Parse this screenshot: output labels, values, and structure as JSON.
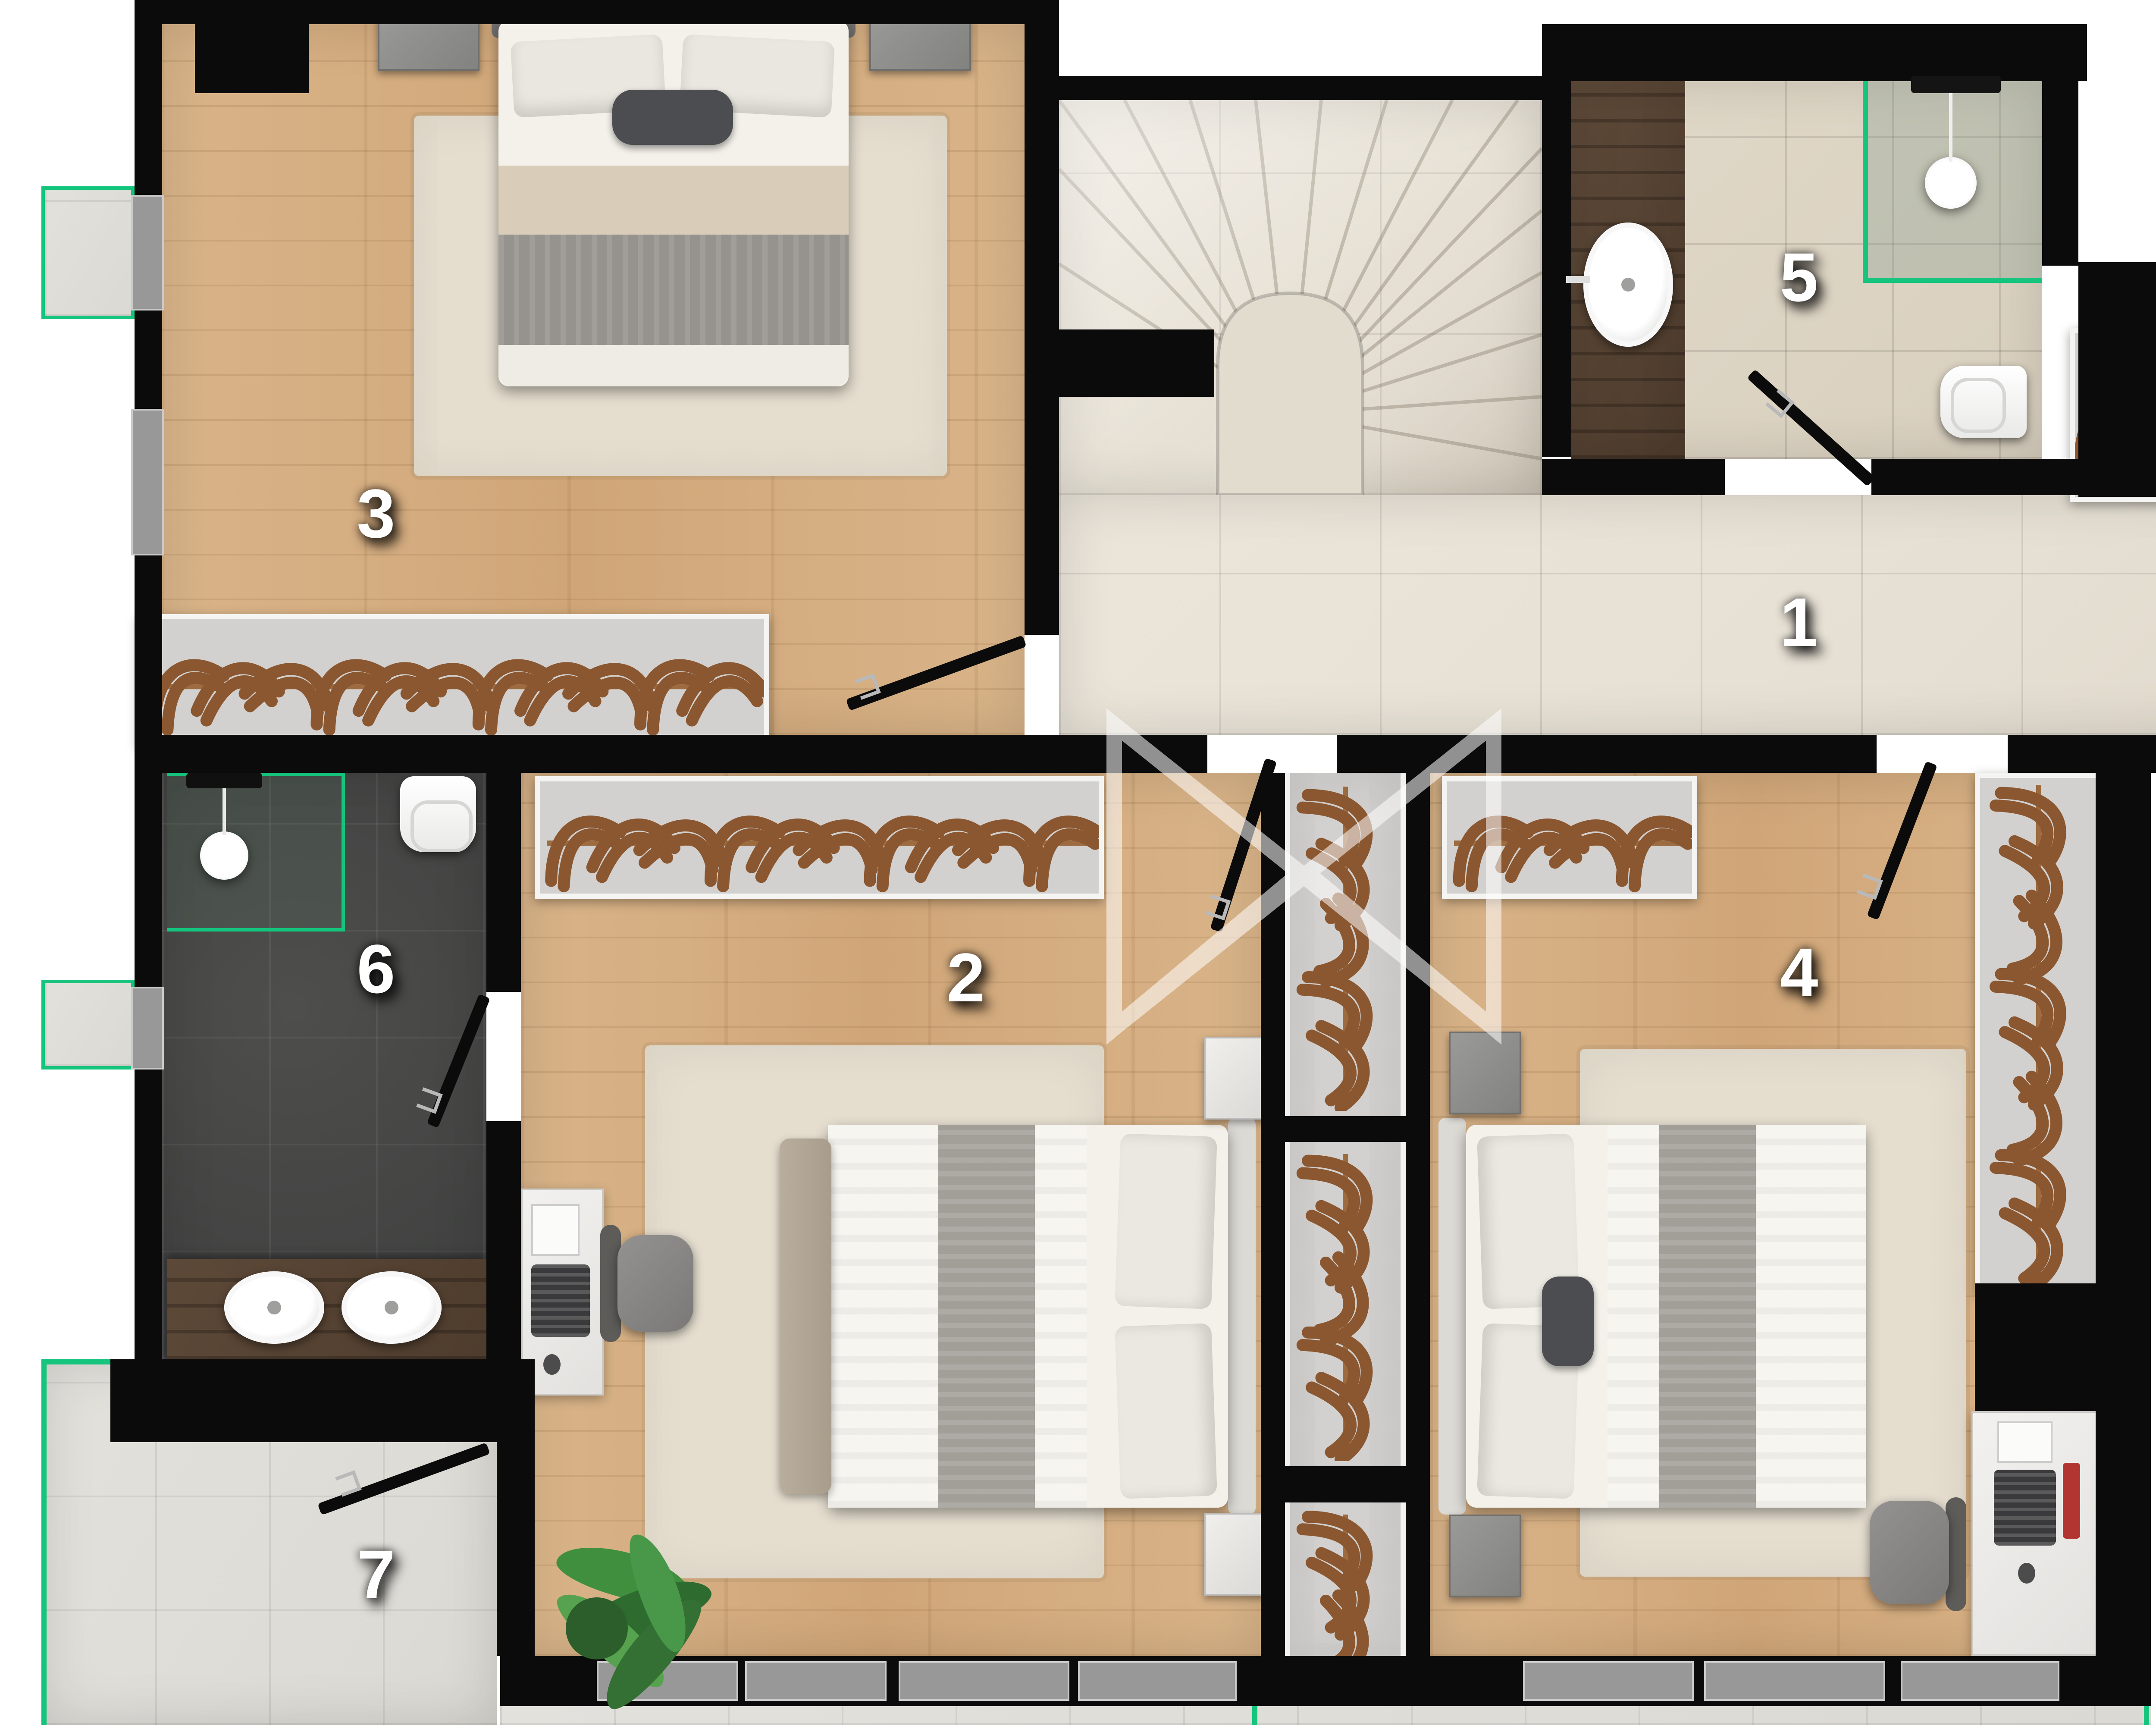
{
  "title": "Alt Kat",
  "rooms": [
    {
      "id": "1",
      "label": "1",
      "type": "hallway"
    },
    {
      "id": "2",
      "label": "2",
      "type": "bedroom"
    },
    {
      "id": "3",
      "label": "3",
      "type": "bedroom"
    },
    {
      "id": "4",
      "label": "4",
      "type": "bedroom"
    },
    {
      "id": "5",
      "label": "5",
      "type": "bathroom"
    },
    {
      "id": "6",
      "label": "6",
      "type": "bathroom"
    },
    {
      "id": "7",
      "label": "7",
      "type": "terrace"
    }
  ],
  "colors": {
    "wall": "#0b0b0b",
    "green": "#15c47d",
    "wood": "#d9b489",
    "wooddark": "#4e3c2d",
    "tile": "#e6e0d4",
    "tilewarm": "#d9d0bf",
    "darkfloor": "#424342",
    "terrace": "#dbd9d3",
    "closet": "#d3d1cf",
    "rug": "#e5decf",
    "hanger": "#8a5730",
    "hangerrail": "#9c6b3f"
  }
}
